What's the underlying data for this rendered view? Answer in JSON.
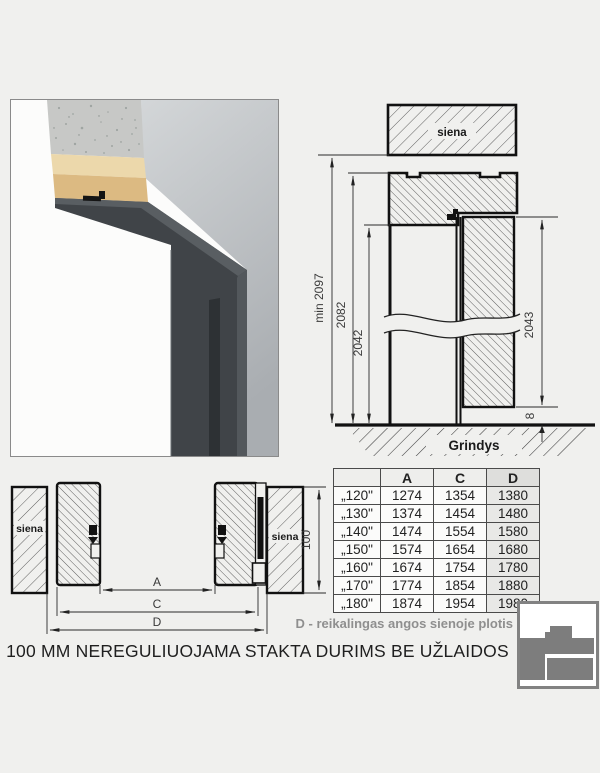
{
  "photo": {
    "name": "door-frame-corner-render"
  },
  "vertical_section": {
    "wall_label": "siena",
    "floor_label": "Grindys",
    "dims": {
      "min_height": "min 2097",
      "frame_height": "2082",
      "opening_height": "2042",
      "leaf_height": "2043",
      "floor_gap": "8"
    }
  },
  "plan_section": {
    "wall_label_left": "siena",
    "wall_label_right": "siena",
    "dims": {
      "a": "A",
      "c": "C",
      "d": "D",
      "depth": "100"
    }
  },
  "table": {
    "headers": [
      "A",
      "C",
      "D"
    ],
    "rows": [
      {
        "size": "„120\"",
        "A": "1274",
        "C": "1354",
        "D": "1380"
      },
      {
        "size": "„130\"",
        "A": "1374",
        "C": "1454",
        "D": "1480"
      },
      {
        "size": "„140\"",
        "A": "1474",
        "C": "1554",
        "D": "1580"
      },
      {
        "size": "„150\"",
        "A": "1574",
        "C": "1654",
        "D": "1680"
      },
      {
        "size": "„160\"",
        "A": "1674",
        "C": "1754",
        "D": "1780"
      },
      {
        "size": "„170\"",
        "A": "1774",
        "C": "1854",
        "D": "1880"
      },
      {
        "size": "„180\"",
        "A": "1874",
        "C": "1954",
        "D": "1980"
      }
    ]
  },
  "footer": {
    "d_note": "D - reikalingas angos sienoje plotis",
    "caption": "100 MM NEREGULIUOJAMA STAKTA DURIMS BE UŽLAIDOS"
  },
  "colors": {
    "background": "#f0f0ee",
    "frame_anthracite": "#404448",
    "note_gray": "#8f8f8f",
    "line": "#1a1a1a"
  }
}
